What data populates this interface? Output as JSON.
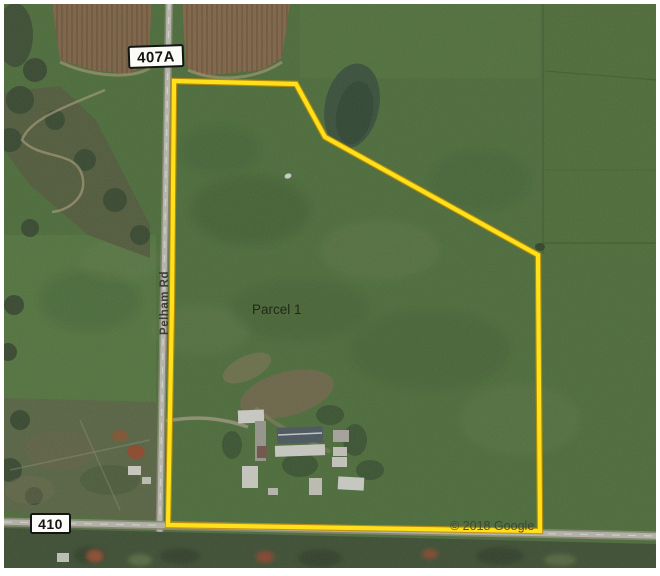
{
  "map": {
    "title": "Aerial parcel map",
    "imagery_type": "satellite",
    "attribution": "© 2018 Google"
  },
  "parcel": {
    "label": "Parcel 1",
    "outline_points": "174,81 296,84 325,137 538,255 540,531 168,525 172,300",
    "boundary_color": "#ffe01a"
  },
  "roads": {
    "vertical_road_name": "Pelham Rd",
    "route_sign_top": "407A",
    "route_sign_bottom": "410"
  },
  "colors": {
    "field_green": "#4e7539",
    "plowed_brown": "#8a6a47",
    "road_gray": "#d2d1c6",
    "pond_dark": "#37523a",
    "sign_bg": "#fbfbf7"
  }
}
